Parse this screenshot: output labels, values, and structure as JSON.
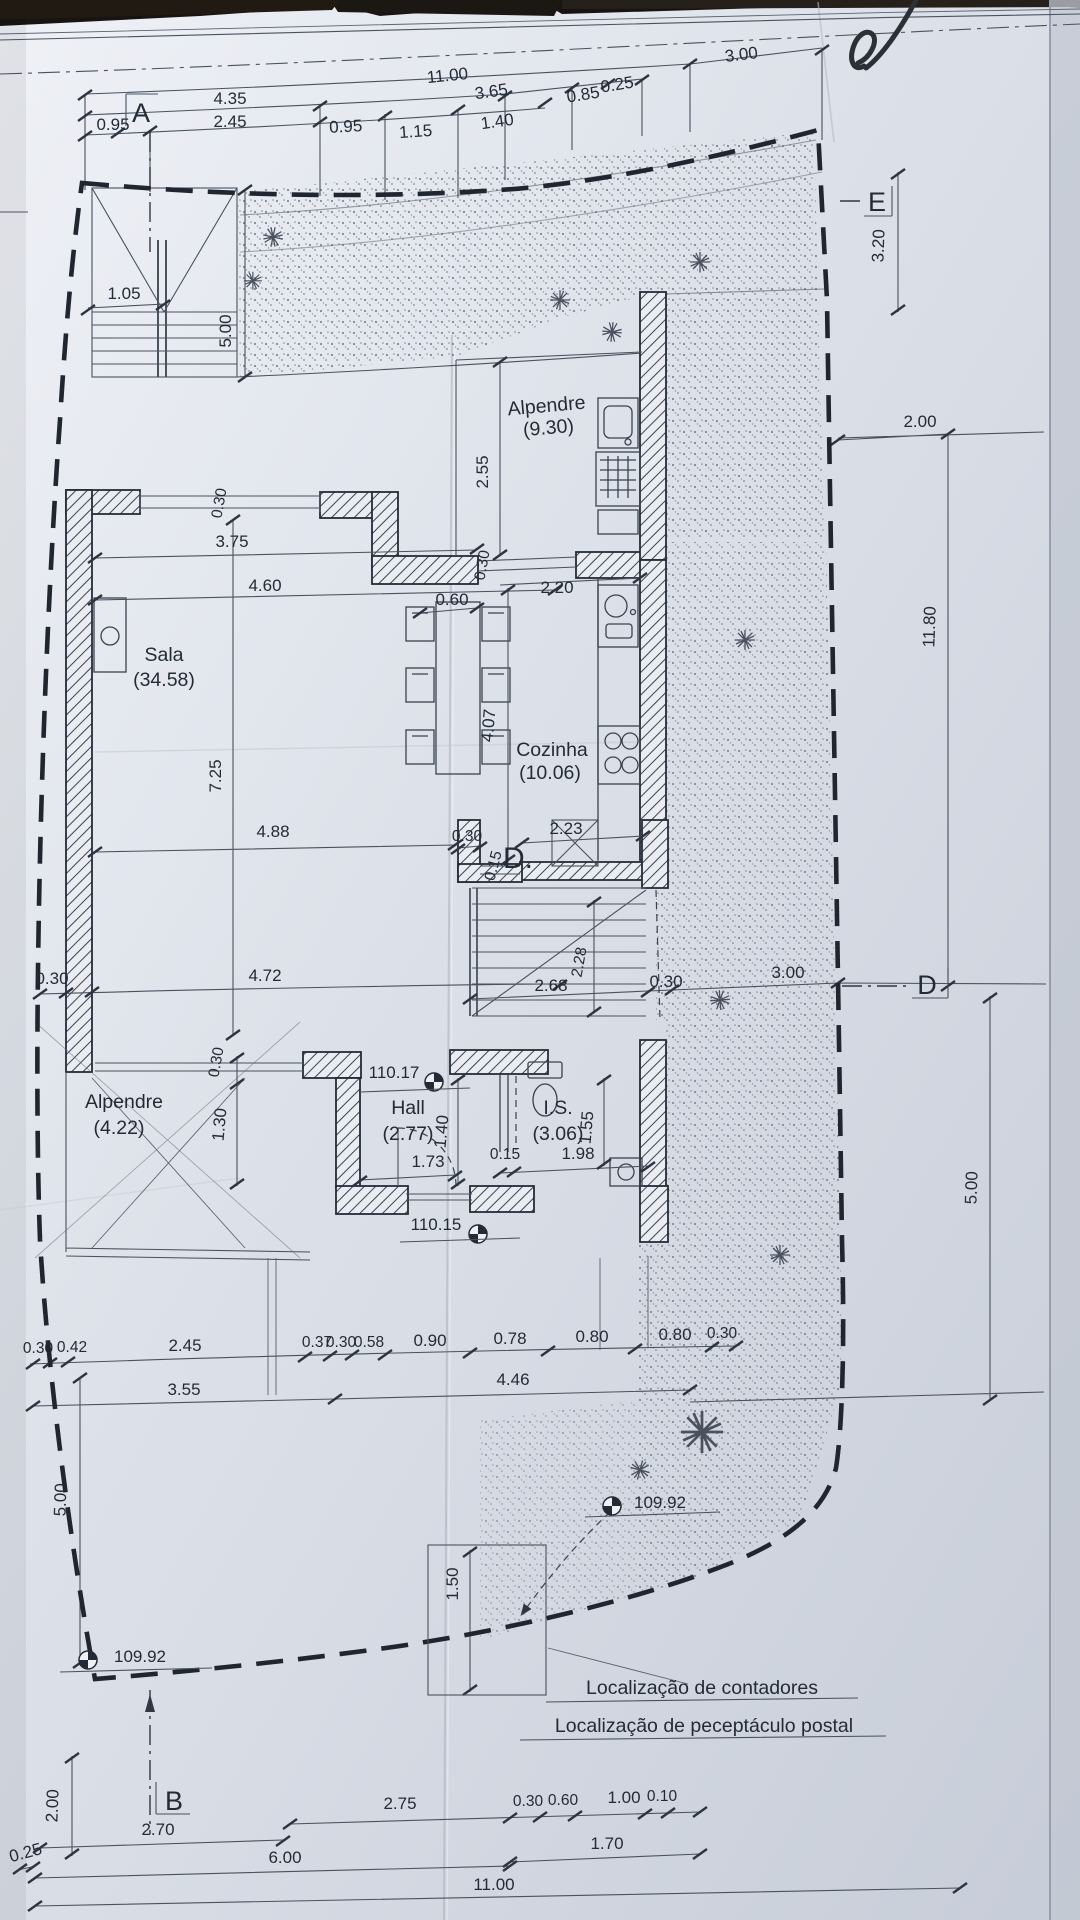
{
  "palette": {
    "ink": "#232b36",
    "paper": "#dde2ea",
    "boundary": "#1f2630",
    "vegetation": "#626a77",
    "photo_bg": "#181411"
  },
  "markers": {
    "a": "A",
    "b": "B",
    "d": "D",
    "e": "E",
    "door_d": "D."
  },
  "rooms": {
    "sala": {
      "name": "Sala",
      "area": "(34.58)"
    },
    "cozinha": {
      "name": "Cozinha",
      "area": "(10.06)"
    },
    "alpendre_top": {
      "name": "Alpendre",
      "area": "(9.30)"
    },
    "alpendre_bottom": {
      "name": "Alpendre",
      "area": "(4.22)"
    },
    "hall": {
      "name": "Hall",
      "area": "(2.77)"
    },
    "is": {
      "name": "I.S.",
      "area": "(3.06)"
    }
  },
  "levels": {
    "hall": "110.17",
    "entry": "110.15",
    "garden_mid": "109.92",
    "garden_low": "109.92"
  },
  "notes": {
    "contadores": "Localização de contadores",
    "postal": "Localização de peceptáculo postal"
  },
  "dims": {
    "top": [
      "4.35",
      "2.45",
      "0.95",
      "0.95",
      "1.15",
      "1.40",
      "11.00",
      "3.65",
      "0.85",
      "0.25",
      "3.00"
    ],
    "left": [
      "1.05",
      "5.00"
    ],
    "right": [
      "3.20",
      "2.00",
      "11.80",
      "5.00"
    ],
    "sala": [
      "3.75",
      "4.60",
      "0.30",
      "7.25",
      "4.88"
    ],
    "kitchen": [
      "2.55",
      "0.30",
      "0.60",
      "2.20",
      "4.07",
      "2.23",
      "0.30",
      "0.15",
      "2.28"
    ],
    "row990": [
      "0.30",
      "4.72",
      "2.68",
      "0.30",
      "3.00"
    ],
    "hall": [
      "1.40",
      "1.73",
      "0.15",
      "1.98",
      "1.55",
      "1.30",
      "0.30"
    ],
    "chain": [
      "0.30",
      "0.42",
      "2.45",
      "0.37",
      "0.30",
      "0.58",
      "0.90",
      "0.78",
      "0.80",
      "0.80",
      "0.30"
    ],
    "chain2": [
      "3.55",
      "4.46"
    ],
    "lower": [
      "5.00",
      "1.50",
      "2.00",
      "0.25"
    ],
    "bottom": [
      "2.75",
      "0.30",
      "0.60",
      "1.00",
      "0.10",
      "1.70",
      "2.70",
      "6.00",
      "11.00"
    ]
  }
}
